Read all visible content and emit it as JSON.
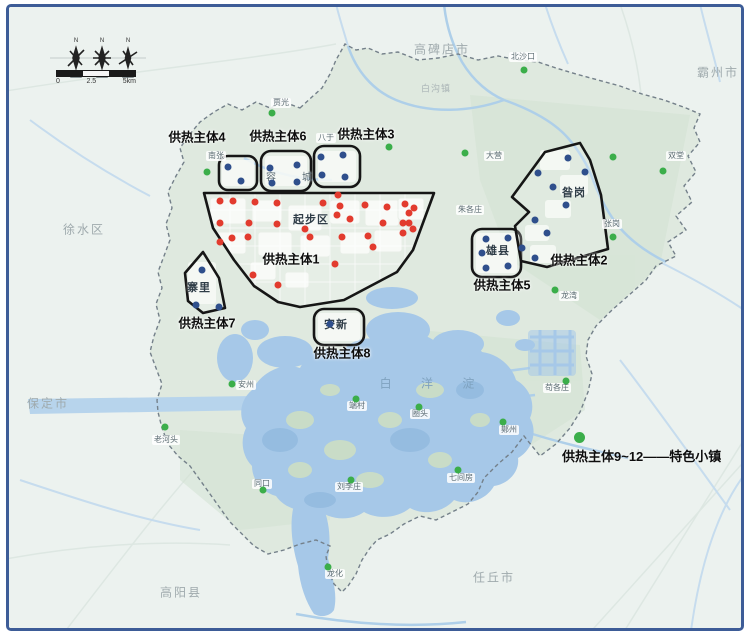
{
  "compass": {
    "north_letter": "N"
  },
  "scale_bar": {
    "ticks": [
      "0",
      "2.5",
      "5km"
    ]
  },
  "legend": {
    "dot_color": "#3bae4a",
    "label": "供热主体9~12——特色小镇"
  },
  "colors": {
    "red": "#e23b2e",
    "blue": "#2f4f8c",
    "green": "#3bae4a",
    "frame": "#3d5c97"
  },
  "zones": [
    {
      "id": "zone-1",
      "label": "供热主体1",
      "label_x": 291,
      "label_y": 258
    },
    {
      "id": "zone-2",
      "label": "供热主体2",
      "label_x": 579,
      "label_y": 259
    },
    {
      "id": "zone-3",
      "label": "供热主体3",
      "label_x": 366,
      "label_y": 133
    },
    {
      "id": "zone-4",
      "label": "供热主体4",
      "label_x": 197,
      "label_y": 136
    },
    {
      "id": "zone-5",
      "label": "供热主体5",
      "label_x": 502,
      "label_y": 284
    },
    {
      "id": "zone-6",
      "label": "供热主体6",
      "label_x": 278,
      "label_y": 135
    },
    {
      "id": "zone-7",
      "label": "供热主体7",
      "label_x": 207,
      "label_y": 322
    },
    {
      "id": "zone-8",
      "label": "供热主体8",
      "label_x": 342,
      "label_y": 352
    }
  ],
  "area_labels": [
    {
      "text": "起步区",
      "x": 311,
      "y": 219
    },
    {
      "text": "容城",
      "x": 289,
      "y": 176,
      "spaced": true
    },
    {
      "text": "寨里",
      "x": 199,
      "y": 287
    },
    {
      "text": "安新",
      "x": 336,
      "y": 324
    },
    {
      "text": "雄县",
      "x": 498,
      "y": 250
    },
    {
      "text": "昝岗",
      "x": 574,
      "y": 192
    }
  ],
  "city_labels": [
    {
      "text": "高碑店市",
      "x": 442,
      "y": 49
    },
    {
      "text": "霸州市",
      "x": 718,
      "y": 72
    },
    {
      "text": "徐水区",
      "x": 84,
      "y": 229
    },
    {
      "text": "保定市",
      "x": 48,
      "y": 403
    },
    {
      "text": "高阳县",
      "x": 181,
      "y": 592
    },
    {
      "text": "任丘市",
      "x": 494,
      "y": 577
    },
    {
      "text": "白沟镇",
      "x": 436,
      "y": 88,
      "small": true
    }
  ],
  "village_labels": [
    {
      "text": "北沙口",
      "x": 523,
      "y": 57
    },
    {
      "text": "贾光",
      "x": 281,
      "y": 103
    },
    {
      "text": "南张",
      "x": 216,
      "y": 156
    },
    {
      "text": "八于",
      "x": 326,
      "y": 138
    },
    {
      "text": "大营",
      "x": 494,
      "y": 156
    },
    {
      "text": "双堂",
      "x": 676,
      "y": 156
    },
    {
      "text": "张岗",
      "x": 612,
      "y": 224
    },
    {
      "text": "朱各庄",
      "x": 470,
      "y": 210
    },
    {
      "text": "龙湾",
      "x": 569,
      "y": 296
    },
    {
      "text": "苟各庄",
      "x": 557,
      "y": 388
    },
    {
      "text": "老河头",
      "x": 166,
      "y": 440
    },
    {
      "text": "安州",
      "x": 246,
      "y": 385
    },
    {
      "text": "同口",
      "x": 262,
      "y": 484
    },
    {
      "text": "刘李庄",
      "x": 349,
      "y": 487
    },
    {
      "text": "圈头",
      "x": 420,
      "y": 414
    },
    {
      "text": "端村",
      "x": 357,
      "y": 406
    },
    {
      "text": "鄚州",
      "x": 509,
      "y": 430
    },
    {
      "text": "七间房",
      "x": 461,
      "y": 478
    },
    {
      "text": "龙化",
      "x": 335,
      "y": 574
    }
  ],
  "lake_label": {
    "text": "白 洋 淀",
    "x": 427,
    "y": 383
  },
  "markers": {
    "red": [
      [
        220,
        201
      ],
      [
        233,
        201
      ],
      [
        255,
        202
      ],
      [
        277,
        203
      ],
      [
        323,
        203
      ],
      [
        338,
        195
      ],
      [
        340,
        206
      ],
      [
        365,
        205
      ],
      [
        387,
        207
      ],
      [
        405,
        204
      ],
      [
        414,
        208
      ],
      [
        409,
        213
      ],
      [
        220,
        223
      ],
      [
        249,
        223
      ],
      [
        277,
        224
      ],
      [
        305,
        229
      ],
      [
        337,
        215
      ],
      [
        350,
        219
      ],
      [
        383,
        223
      ],
      [
        403,
        223
      ],
      [
        409,
        223
      ],
      [
        232,
        238
      ],
      [
        248,
        237
      ],
      [
        220,
        242
      ],
      [
        310,
        237
      ],
      [
        342,
        237
      ],
      [
        368,
        236
      ],
      [
        373,
        247
      ],
      [
        403,
        233
      ],
      [
        413,
        229
      ],
      [
        335,
        264
      ],
      [
        253,
        275
      ],
      [
        278,
        285
      ]
    ],
    "blue": [
      [
        228,
        167
      ],
      [
        241,
        181
      ],
      [
        270,
        168
      ],
      [
        297,
        165
      ],
      [
        272,
        183
      ],
      [
        297,
        182
      ],
      [
        321,
        157
      ],
      [
        343,
        155
      ],
      [
        322,
        175
      ],
      [
        345,
        177
      ],
      [
        202,
        270
      ],
      [
        196,
        305
      ],
      [
        219,
        307
      ],
      [
        330,
        324
      ],
      [
        486,
        239
      ],
      [
        508,
        238
      ],
      [
        482,
        253
      ],
      [
        486,
        268
      ],
      [
        508,
        266
      ],
      [
        568,
        158
      ],
      [
        585,
        172
      ],
      [
        538,
        173
      ],
      [
        553,
        187
      ],
      [
        566,
        205
      ],
      [
        535,
        220
      ],
      [
        547,
        233
      ],
      [
        522,
        248
      ],
      [
        535,
        258
      ]
    ],
    "green": [
      [
        524,
        70
      ],
      [
        272,
        113
      ],
      [
        207,
        172
      ],
      [
        389,
        147
      ],
      [
        465,
        153
      ],
      [
        663,
        171
      ],
      [
        613,
        157
      ],
      [
        613,
        237
      ],
      [
        555,
        290
      ],
      [
        566,
        381
      ],
      [
        165,
        427
      ],
      [
        232,
        384
      ],
      [
        263,
        490
      ],
      [
        351,
        480
      ],
      [
        419,
        407
      ],
      [
        356,
        399
      ],
      [
        503,
        422
      ],
      [
        458,
        470
      ],
      [
        328,
        567
      ]
    ]
  }
}
